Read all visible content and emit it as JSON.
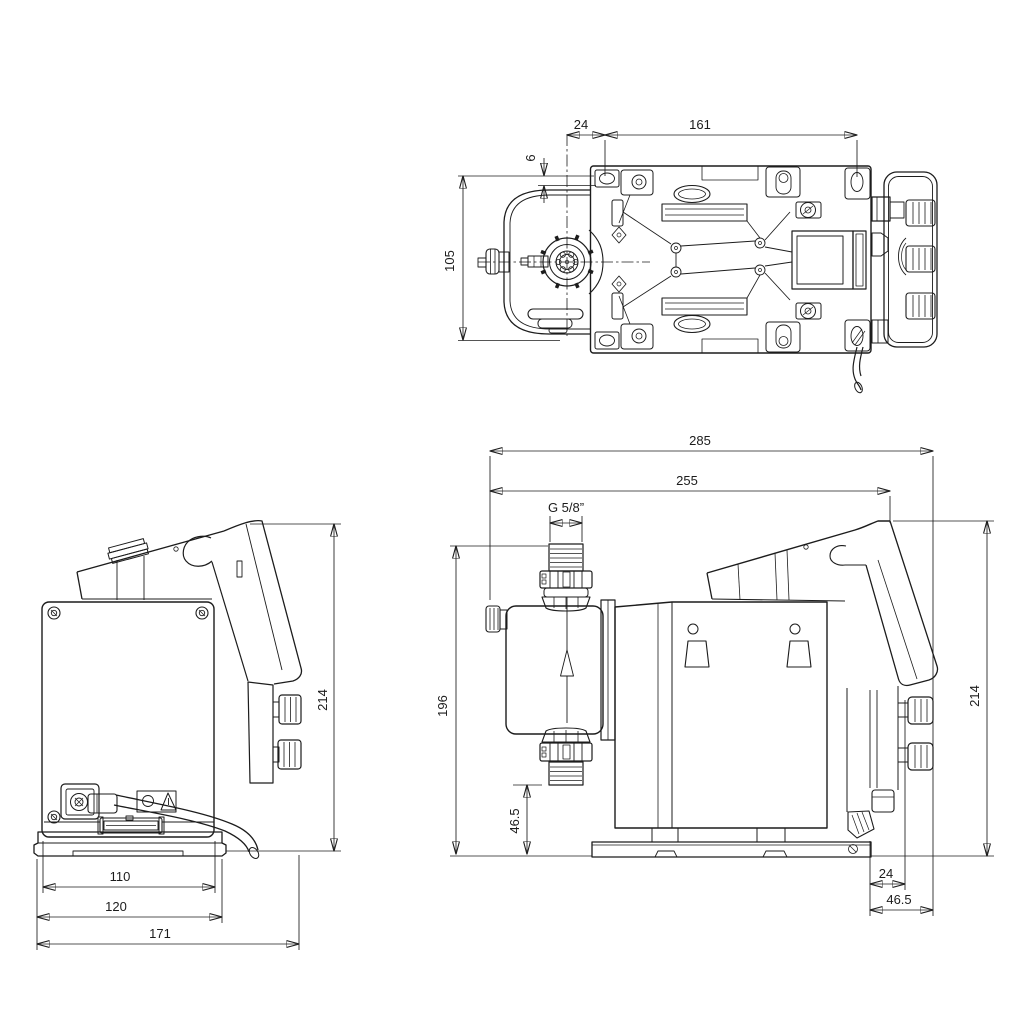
{
  "drawing": {
    "background_color": "#ffffff",
    "line_color": "#1c1c1c",
    "top_view": {
      "dim_24": "24",
      "dim_161": "161",
      "dim_6": "6",
      "dim_105": "105"
    },
    "front_view": {
      "dim_214": "214",
      "dim_110": "110",
      "dim_120": "120",
      "dim_171": "171"
    },
    "side_view": {
      "dim_285": "285",
      "dim_255": "255",
      "thread_label": "G 5/8”",
      "dim_196": "196",
      "dim_46_5_side": "46.5",
      "dim_214": "214",
      "dim_24": "24",
      "dim_46_5_bottom": "46.5"
    }
  }
}
